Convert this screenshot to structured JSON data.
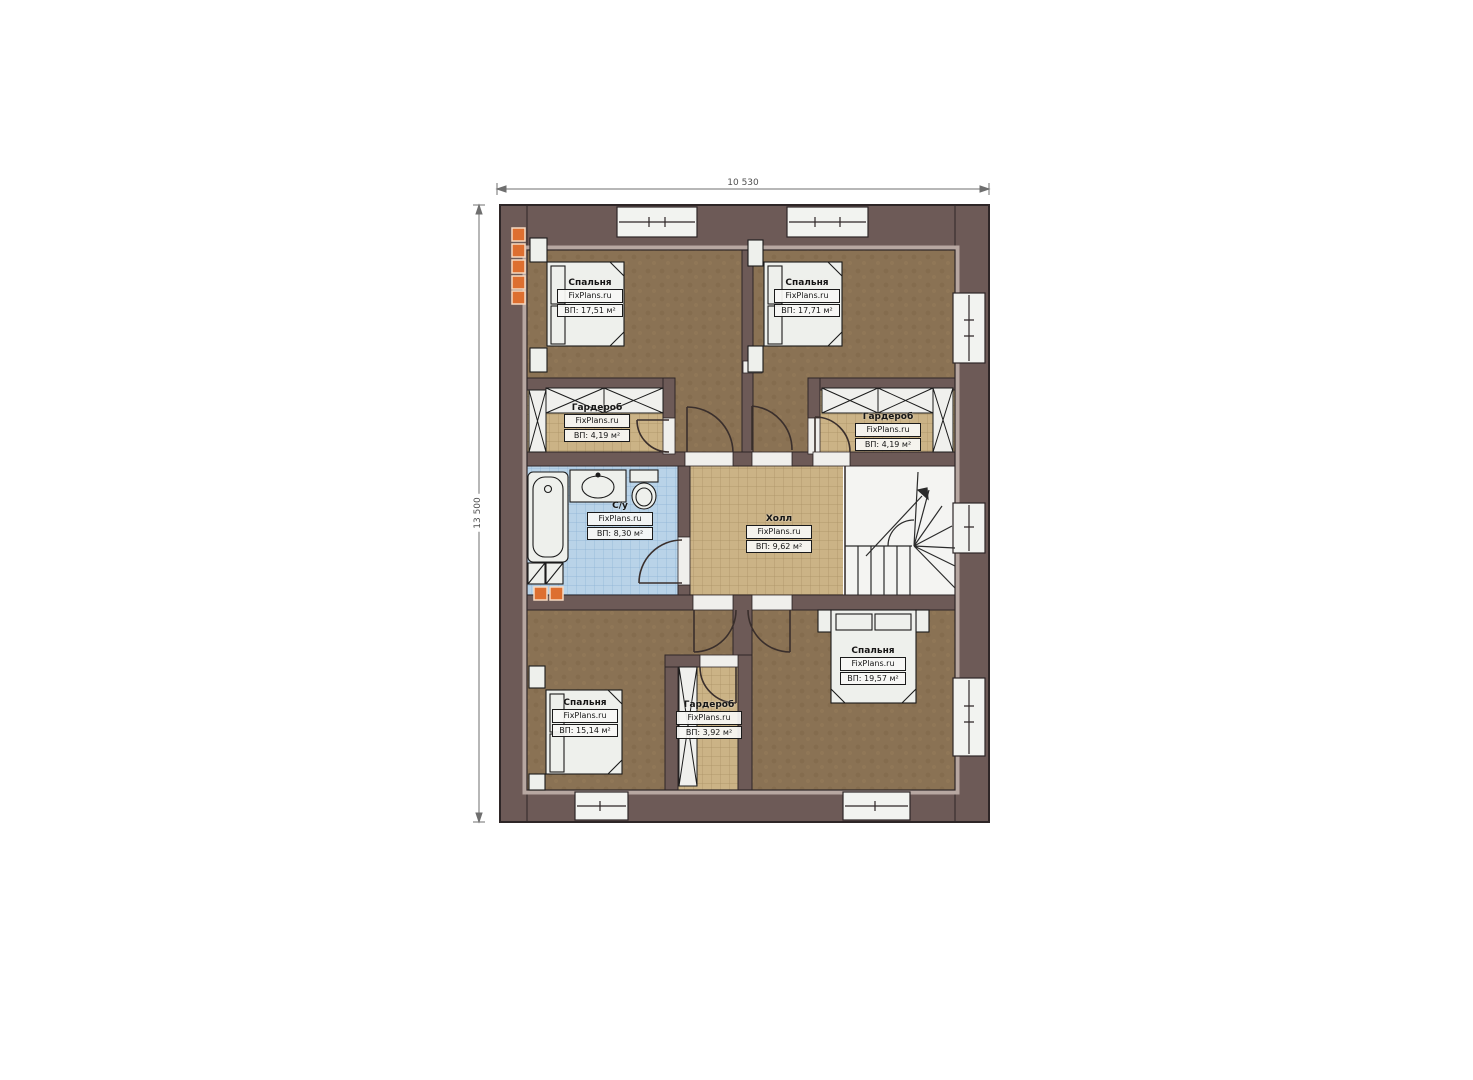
{
  "title": "План этажа",
  "brand": "FixPlans.ru",
  "dimensions": {
    "top": "10 530",
    "left": "13 500"
  },
  "rooms": [
    {
      "id": "bedroom-top-left",
      "name": "Спальня",
      "brand": "FixPlans.ru",
      "area": "ВП: 17,51 м²"
    },
    {
      "id": "bedroom-top-right",
      "name": "Спальня",
      "brand": "FixPlans.ru",
      "area": "ВП: 17,71 м²"
    },
    {
      "id": "wardrobe-left",
      "name": "Гардероб",
      "brand": "FixPlans.ru",
      "area": "ВП: 4,19 м²"
    },
    {
      "id": "wardrobe-right",
      "name": "Гардероб",
      "brand": "FixPlans.ru",
      "area": "ВП: 4,19 м²"
    },
    {
      "id": "bathroom",
      "name": "С/у",
      "brand": "FixPlans.ru",
      "area": "ВП: 8,30 м²"
    },
    {
      "id": "hall",
      "name": "Холл",
      "brand": "FixPlans.ru",
      "area": "ВП: 9,62 м²"
    },
    {
      "id": "bedroom-bottom-left",
      "name": "Спальня",
      "brand": "FixPlans.ru",
      "area": "ВП: 15,14 м²"
    },
    {
      "id": "wardrobe-bottom",
      "name": "Гардероб",
      "brand": "FixPlans.ru",
      "area": "ВП: 3,92 м²"
    },
    {
      "id": "bedroom-bottom-right",
      "name": "Спальня",
      "brand": "FixPlans.ru",
      "area": "ВП: 19,57 м²"
    }
  ],
  "colors": {
    "wall": "#6d5a57",
    "bedroom_floor": "#8a7254",
    "wardrobe_floor": "#cbb386",
    "bathroom_floor": "#b9d3e8",
    "stair_floor": "#f4f4f2",
    "accent_orange": "#dd6f30"
  }
}
